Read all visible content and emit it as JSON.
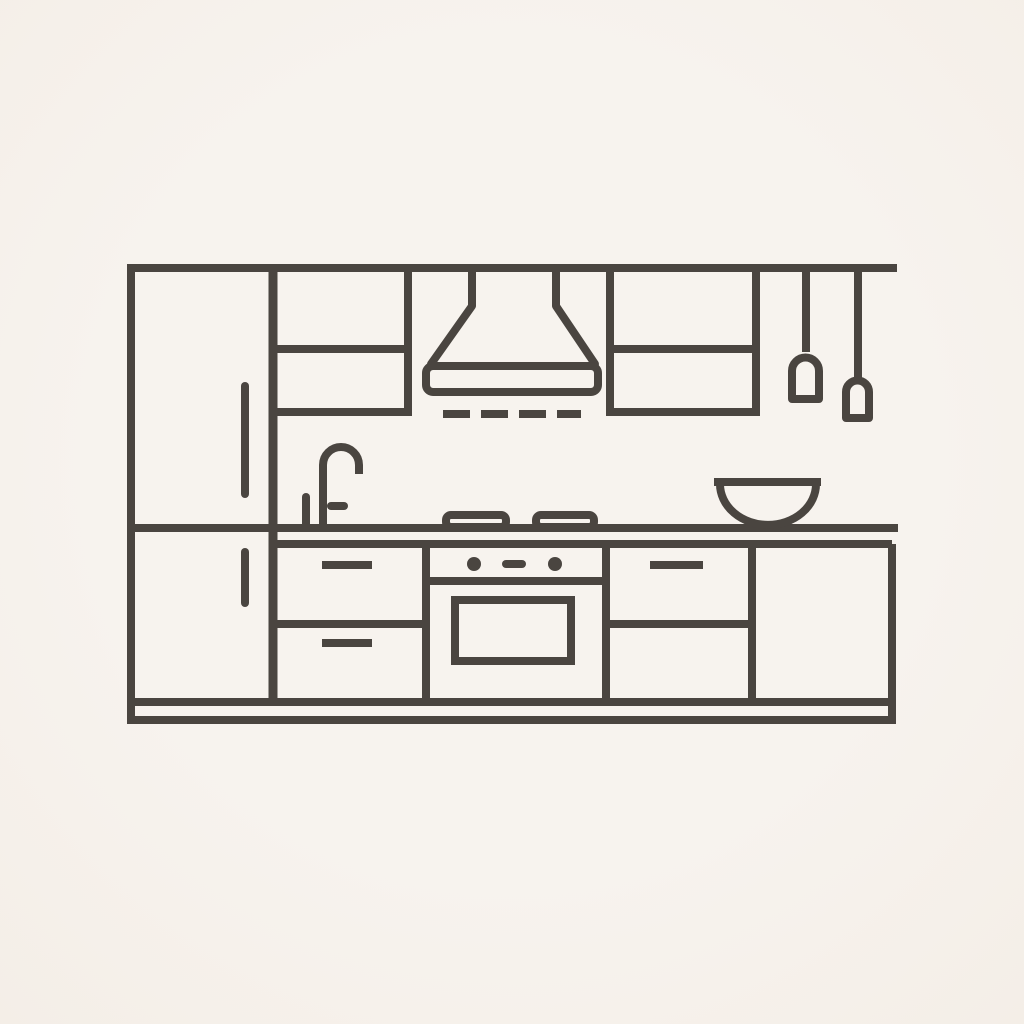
{
  "scene": {
    "description": "Minimalist flat line illustration of a kitchen wall unit",
    "colors": {
      "background": "#f7f3ee",
      "line": "#4a4540"
    }
  },
  "elements": [
    "top-rail",
    "refrigerator",
    "refrigerator-handle-upper",
    "refrigerator-handle-lower",
    "upper-cabinet-left",
    "upper-cabinet-right",
    "range-hood",
    "hood-vent-dashes",
    "hanging-utensil-left",
    "hanging-utensil-right",
    "faucet",
    "faucet-handle",
    "soap-pump",
    "countertop",
    "burner-left",
    "burner-right",
    "mixing-bowl",
    "drawer-stack-left",
    "drawer-handle",
    "oven",
    "oven-knob",
    "oven-door",
    "drawer-stack-right",
    "base-cabinet-right",
    "plinth"
  ]
}
